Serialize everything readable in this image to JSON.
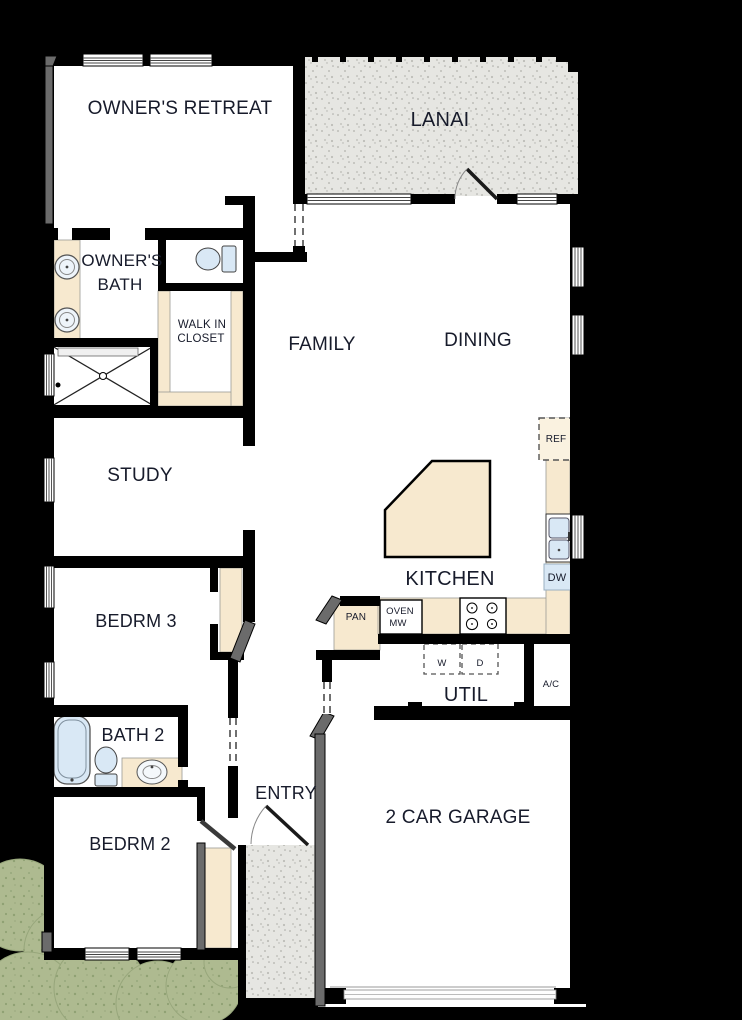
{
  "labels": {
    "owners_retreat": "OWNER'S RETREAT",
    "lanai": "LANAI",
    "owners_bath_1": "OWNER'S",
    "owners_bath_2": "BATH",
    "walk_in_closet_1": "WALK IN",
    "walk_in_closet_2": "CLOSET",
    "family": "FAMILY",
    "dining": "DINING",
    "study": "STUDY",
    "kitchen": "KITCHEN",
    "bedrm3": "BEDRM 3",
    "util": "UTIL",
    "bath2": "BATH 2",
    "bedrm2": "BEDRM 2",
    "entry": "ENTRY",
    "garage": "2 CAR GARAGE"
  },
  "fixtures": {
    "ref": "REF",
    "dw": "DW",
    "pan": "PAN",
    "oven": "OVEN",
    "mw": "MW",
    "washer": "W",
    "dryer": "D",
    "ac": "A/C"
  },
  "colors": {
    "wall": "#000000",
    "floor": "#ffffff",
    "counter": "#f7e9cf",
    "fixture_blue": "#d9e8f5",
    "concrete": "#e6e6e2",
    "shrub": "#aeba90",
    "gray_wall": "#6b6b6b",
    "text": "#171b2b"
  }
}
